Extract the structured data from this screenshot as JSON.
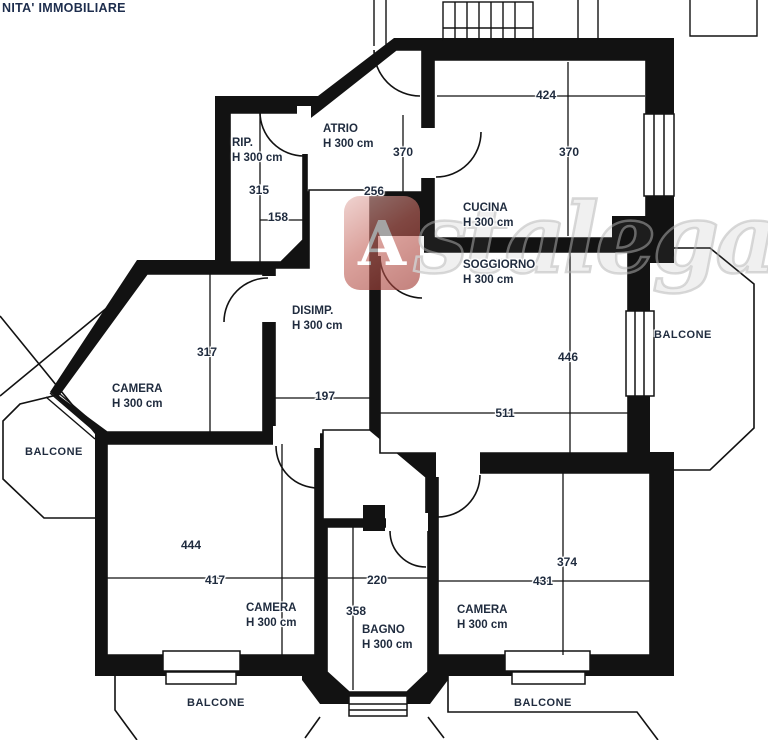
{
  "title": "NITA' IMMOBILIARE",
  "watermark": {
    "logo_letter": "A",
    "text": "stalegale.ne",
    "accent_color": "#b5433c",
    "gray_color": "#c9c9c9"
  },
  "colors": {
    "wall": "#121212",
    "label_text": "#1f2b3e",
    "background": "#ffffff"
  },
  "rooms": {
    "rip": {
      "name": "RIP.",
      "height": "H 300 cm"
    },
    "atrio": {
      "name": "ATRIO",
      "height": "H 300 cm"
    },
    "cucina": {
      "name": "CUCINA",
      "height": "H 300 cm"
    },
    "soggiorno": {
      "name": "SOGGIORNO",
      "height": "H 300 cm"
    },
    "disimp": {
      "name": "DISIMP.",
      "height": "H 300 cm"
    },
    "camera_nw": {
      "name": "CAMERA",
      "height": "H 300 cm"
    },
    "camera_sw": {
      "name": "CAMERA",
      "height": "H 300 cm"
    },
    "camera_se": {
      "name": "CAMERA",
      "height": "H 300 cm"
    },
    "bagno": {
      "name": "BAGNO",
      "height": "H 300 cm"
    }
  },
  "balconies": {
    "west": "BALCONE",
    "east": "BALCONE",
    "south_west": "BALCONE",
    "south_east": "BALCONE"
  },
  "dimensions": {
    "rip_width": "158",
    "rip_depth": "315",
    "atrio_width": "256",
    "atrio_depth": "370",
    "cucina_width": "424",
    "cucina_depth": "370",
    "disimp_width": "197",
    "camera_nw_depth": "317",
    "soggiorno_width": "511",
    "soggiorno_depth": "446",
    "camera_sw_width": "417",
    "camera_sw_depth": "444",
    "bagno_width": "220",
    "bagno_depth": "358",
    "camera_se_width": "431",
    "camera_se_depth": "374"
  }
}
